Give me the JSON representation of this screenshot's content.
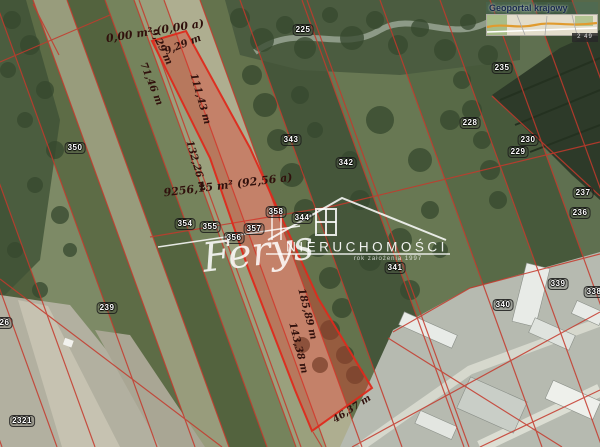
{
  "minimap": {
    "title": "Geoportal krajowy",
    "badge": "2 49"
  },
  "watermark": {
    "brand": "NIERUCHOMOŚCI",
    "signature": "Ferys",
    "tagline": "rok założenia 1997"
  },
  "colors": {
    "cadastral_line": "#c5392c",
    "parcel_fill": "#e8372b",
    "parcel_outline": "#de2a1c",
    "measurement_text": "#30100c"
  },
  "parcel_labels": [
    "225",
    "235",
    "228",
    "230",
    "229",
    "237",
    "236",
    "343",
    "342",
    "350",
    "354",
    "355",
    "356",
    "357",
    "358",
    "344",
    "341",
    "340",
    "339",
    "338",
    "239",
    "226",
    "2321"
  ],
  "measurement_labels": [
    "0,00 m² (0,00 a)",
    "9,29 m",
    "9,29 m",
    "71,46 m",
    "111,43 m",
    "132,26 m",
    "9256,15 m² (92,56 a)",
    "185,89 m",
    "143,38 m",
    "46,37 m"
  ]
}
